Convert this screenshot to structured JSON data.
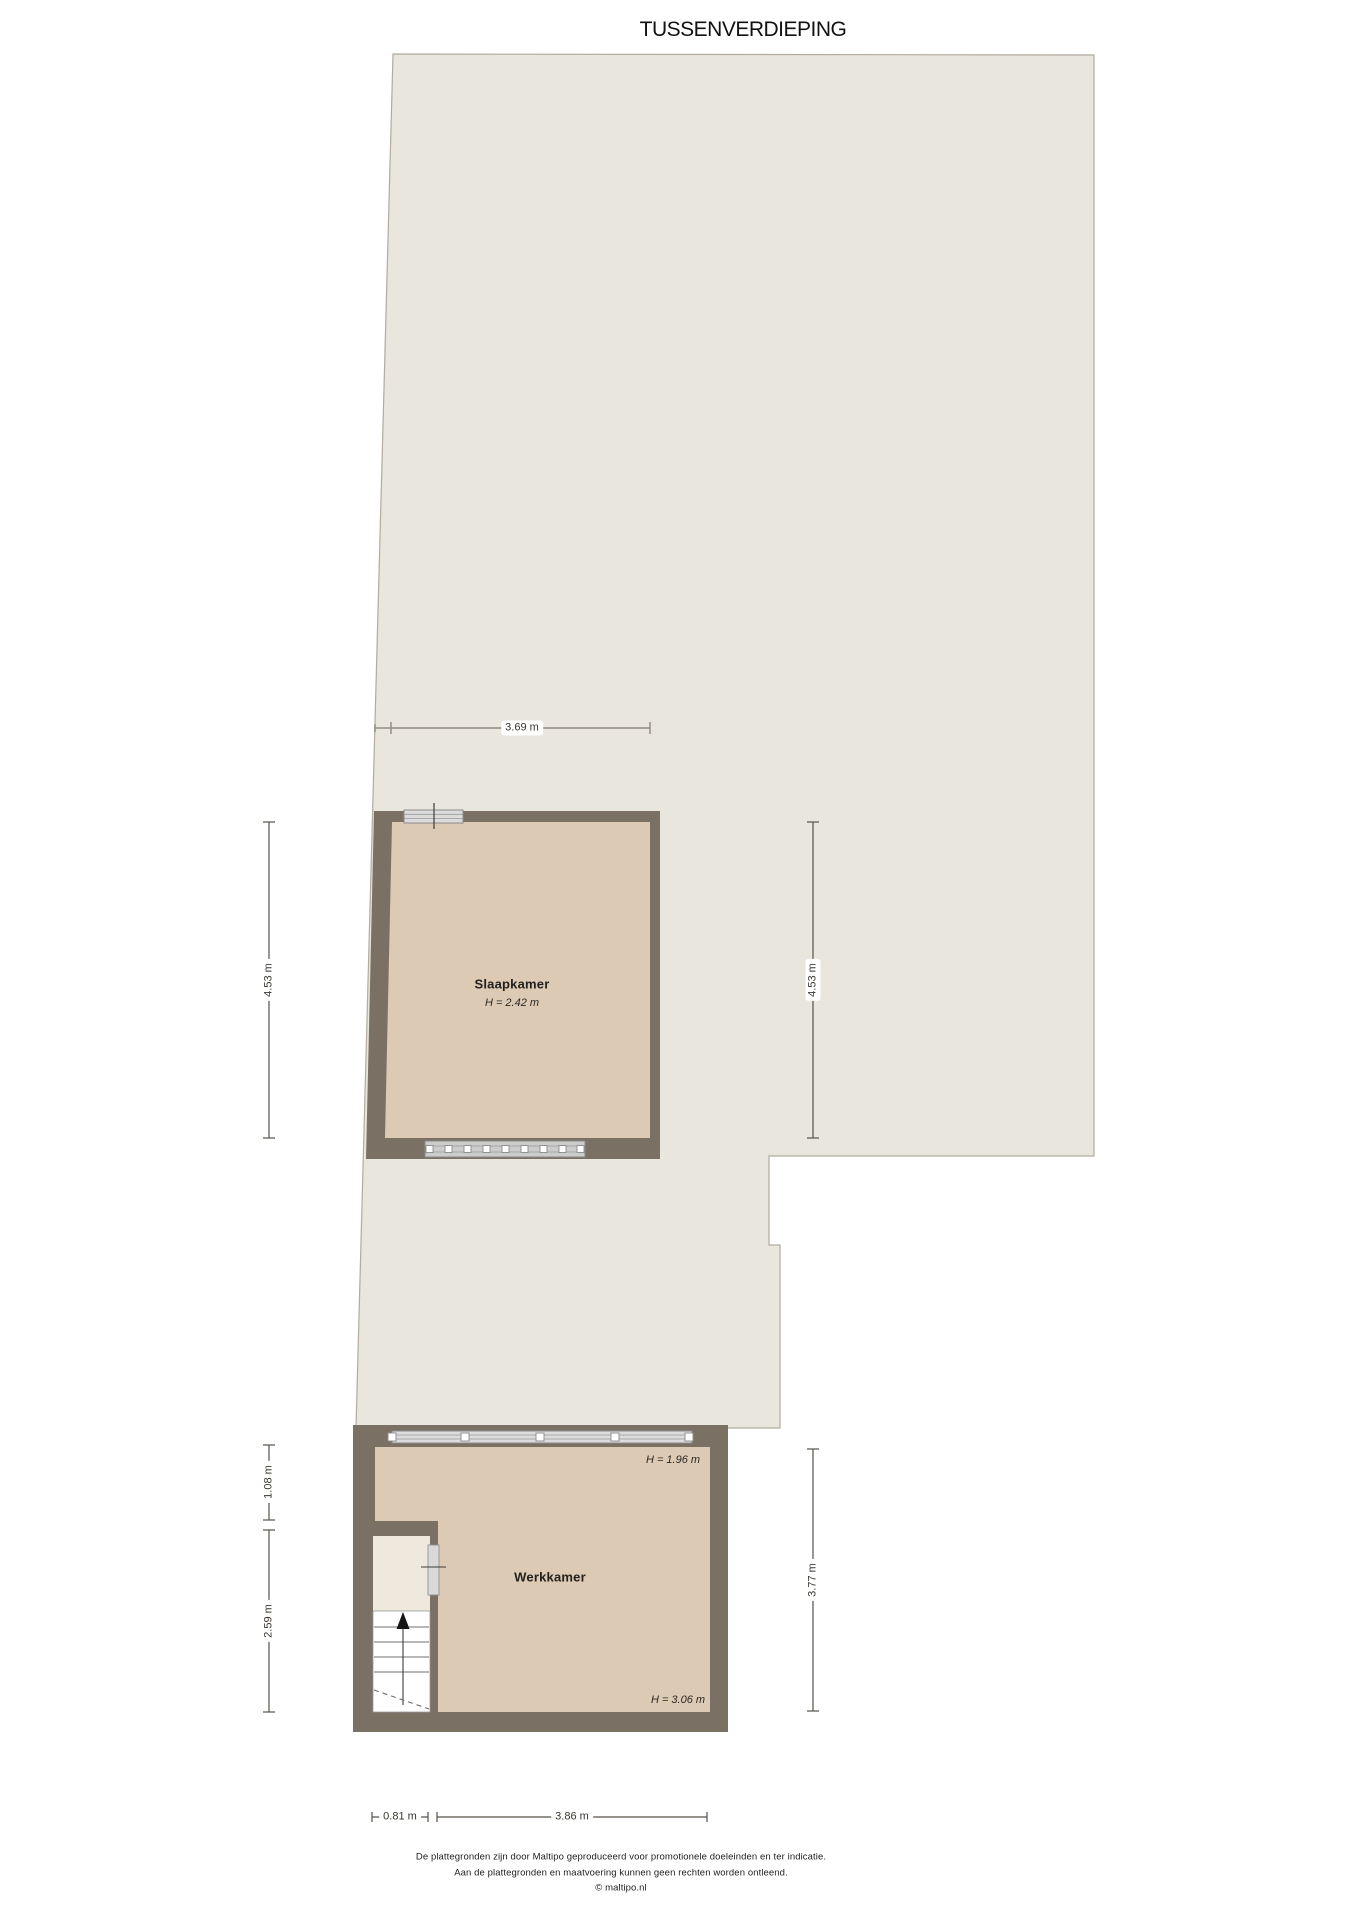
{
  "title": "TUSSENVERDIEPING",
  "floor": {
    "rooms": [
      {
        "id": "slaapkamer",
        "name": "Slaapkamer",
        "ceiling": "H = 2.42 m"
      },
      {
        "id": "werkkamer",
        "name": "Werkkamer",
        "ceiling_low": "H = 1.96 m",
        "ceiling_high": "H = 3.06 m"
      }
    ]
  },
  "dimensions": {
    "slaapkamer_width": "3.69 m",
    "slaapkamer_depth_left": "4.53 m",
    "open_area_depth_right": "4.53 m",
    "closet_depth": "1.08 m",
    "stair_depth": "2.59 m",
    "werkkamer_depth": "3.77 m",
    "stair_width": "0.81 m",
    "werkkamer_width": "3.86 m"
  },
  "footer": {
    "line1": "De plattegronden zijn door Maltipo geproduceerd voor promotionele doeleinden en ter indicatie.",
    "line2": "Aan de plattegronden en maatvoering kunnen geen rechten worden ontleend.",
    "line3": "© maltipo.nl"
  },
  "colors": {
    "wall": "#7b7064",
    "room_floor": "#dccab4",
    "open_area": "#e9e6de",
    "closet": "#efe9dd",
    "stairs": "#ffffff",
    "window": "#d9d9d9",
    "dimension_line": "#6e685f",
    "text": "#1f1f1f"
  }
}
